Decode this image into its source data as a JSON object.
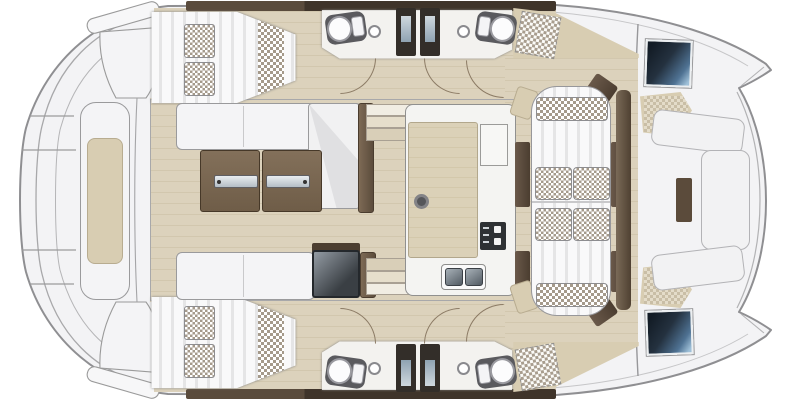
{
  "image": {
    "width": 802,
    "height": 400,
    "kind": "catamaran-deck-floor-plan"
  },
  "palette": {
    "page_bg": "#ffffff",
    "deck": "#f3f3f5",
    "deck_line": "#8f8f92",
    "floor": "#dcd2bc",
    "floor_line": "#d2c7ae",
    "heads_floor": "#f3f2ef",
    "wood": "#7b6852",
    "wood_dark": "#4c3e30",
    "wood_door": "#57483a",
    "cushion": "#f7f7f8",
    "cushion_stripe": "#e5e5e6",
    "check": "#a59a8b",
    "tan": "#d8cdb2",
    "tan_line": "#b8ac90",
    "hatch_dark": "#1d2833",
    "hatch_light": "#6c8fae",
    "appliance": "#3c4045",
    "steel_light": "#e9edf0",
    "steel_dark": "#b4bec5"
  },
  "features": [
    "aft-swim-platform",
    "aft-bench",
    "port-aft-cabin-berth",
    "starboard-aft-cabin-berth",
    "port-heads-with-shower",
    "starboard-heads-with-shower",
    "salon-l-sofa",
    "salon-folding-table",
    "salon-bench",
    "cool-box",
    "galley-island",
    "galley-stove",
    "galley-double-sink",
    "companionway-doors",
    "cockpit-lounge-sunbed",
    "checkered-scatter-pillows",
    "foredeck-u-seating",
    "bow-deck-hatches",
    "hull-access-steps"
  ]
}
